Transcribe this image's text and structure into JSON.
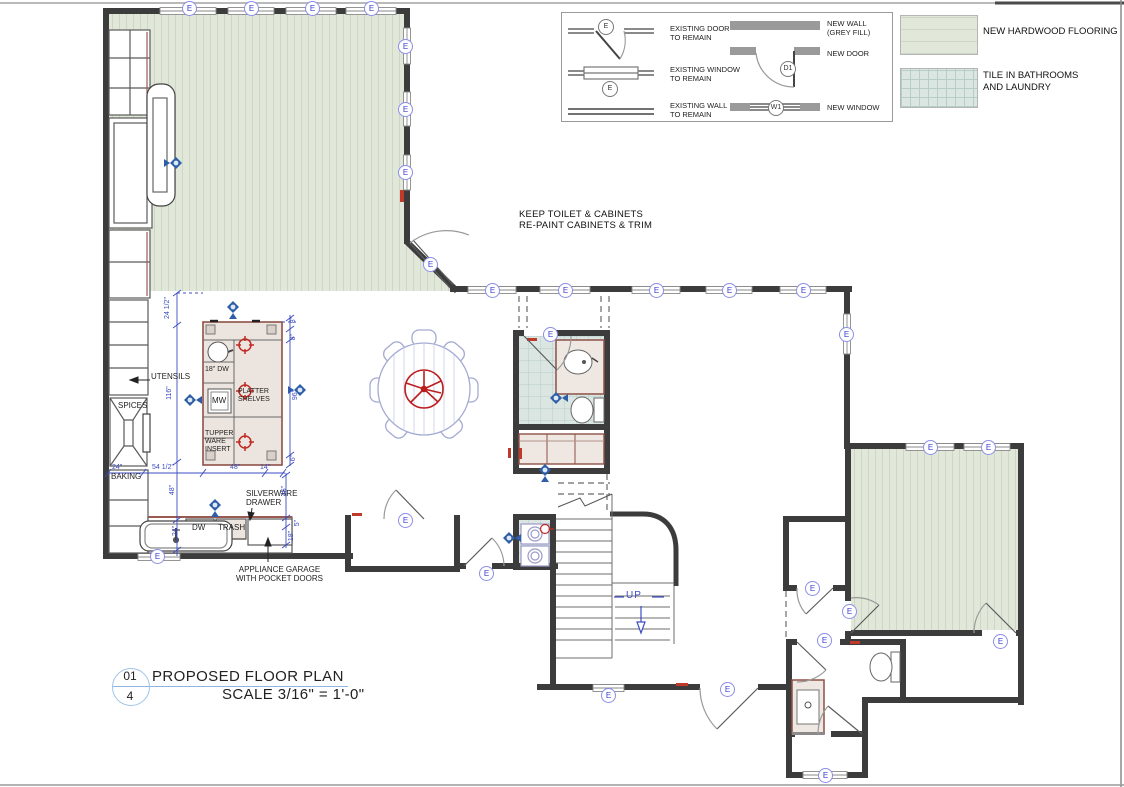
{
  "notes": {
    "toilet_note": "KEEP TOILET & CABINETS\nRE-PAINT CABINETS & TRIM",
    "up": "UP"
  },
  "symbols": {
    "existing": "E",
    "new_door": "D1",
    "new_window": "W1"
  },
  "legend": {
    "existing_door": "EXISTING DOOR\nTO REMAIN",
    "existing_window": "EXISTING WINDOW\nTO REMAIN",
    "existing_wall": "EXISTING WALL\nTO REMAIN",
    "new_wall": "NEW WALL\n(GREY FILL)",
    "new_door": "NEW DOOR",
    "new_window": "NEW WINDOW",
    "hardwood": "NEW HARDWOOD  FLOORING",
    "tile": "TILE IN BATHROOMS\nAND LAUNDRY"
  },
  "kitchen": {
    "utensils": "UTENSILS",
    "spices": "SPICES",
    "baking": "BAKING",
    "dw18": "18\" DW",
    "mw": "MW",
    "platter": "PLATTER\nSHELVES",
    "tupperware": "TUPPER\nWARE\nINSERT",
    "dw": "DW",
    "trash": "TRASH",
    "silverware": "SILVERWARE\nDRAWER",
    "appliance_garage": "APPLIANCE GARAGE\nWITH POCKET DOORS"
  },
  "dims": {
    "d24h": "24 1/2\"",
    "d116": "116\"",
    "d54h": "54 1/2\"",
    "d48": "48\"",
    "d14": "14\"",
    "d24": "24\"",
    "d96": "96\"",
    "d8": "8\"",
    "d6": "6\"",
    "d45": "45\"",
    "d5": "5\"",
    "d18": "18\""
  },
  "title_block": {
    "number": "01",
    "sheet": "4",
    "title": "PROPOSED FLOOR PLAN",
    "scale": "SCALE 3/16\" = 1'-0\""
  }
}
